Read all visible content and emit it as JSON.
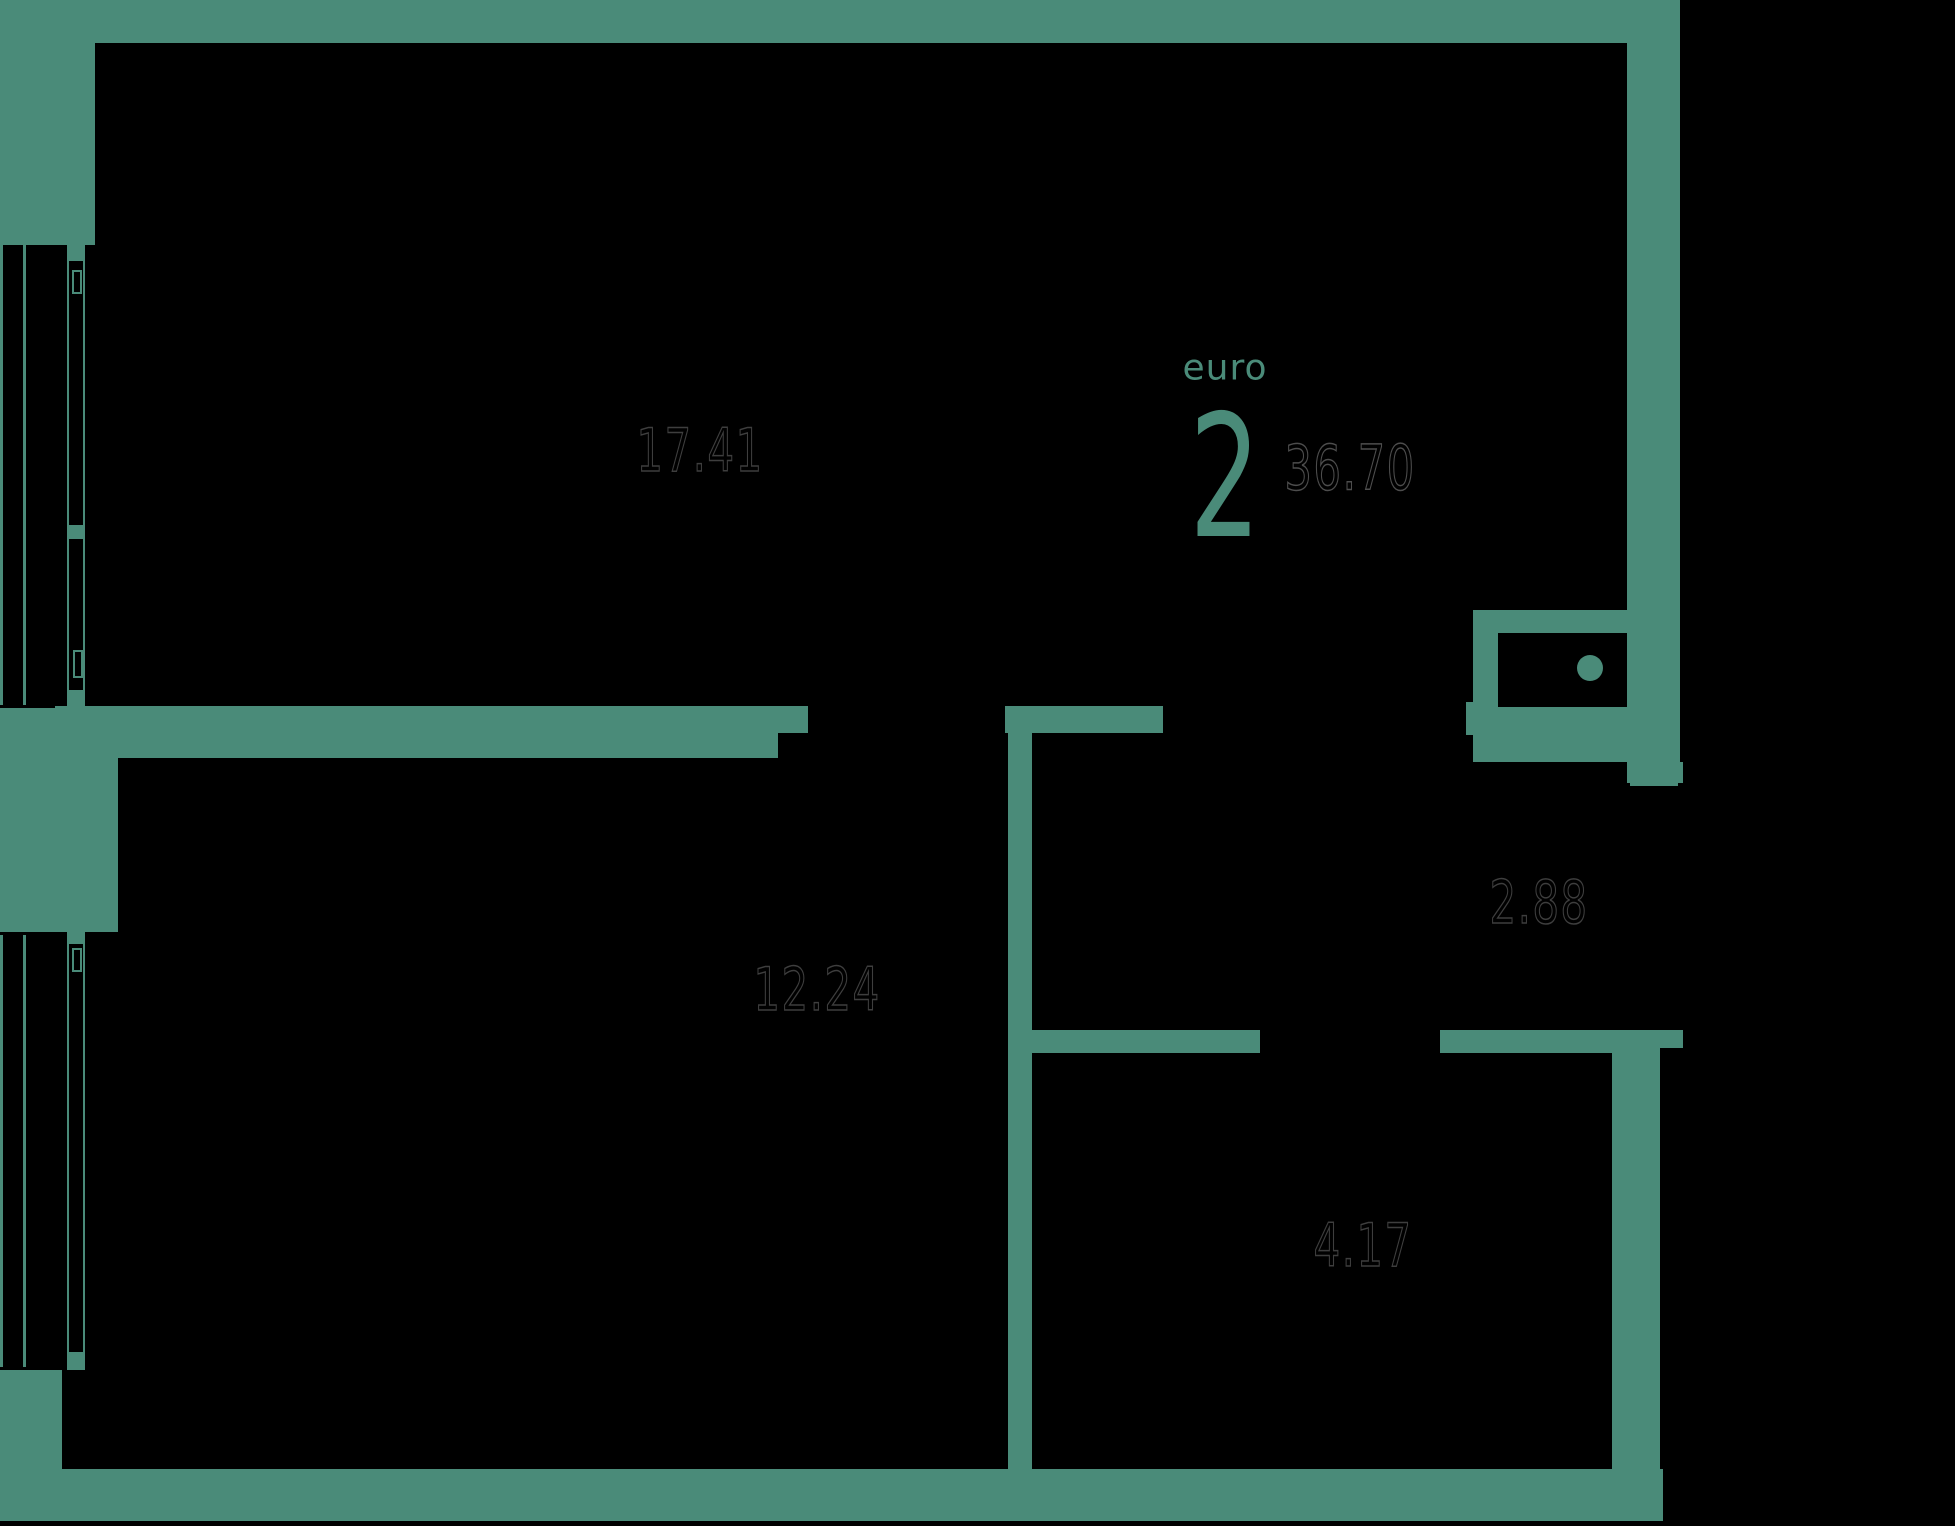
{
  "apartment": {
    "type_label": "euro",
    "rooms_count": "2",
    "total_area": "36.70",
    "room_areas": {
      "living_kitchen": "17.41",
      "bedroom": "12.24",
      "hallway": "2.88",
      "bathroom": "4.17"
    },
    "colors": {
      "wall": "#4a8b79",
      "background": "#000000",
      "area_label_outline": "#3e3e3e",
      "total_area_outline": "#4d4d4d"
    }
  }
}
